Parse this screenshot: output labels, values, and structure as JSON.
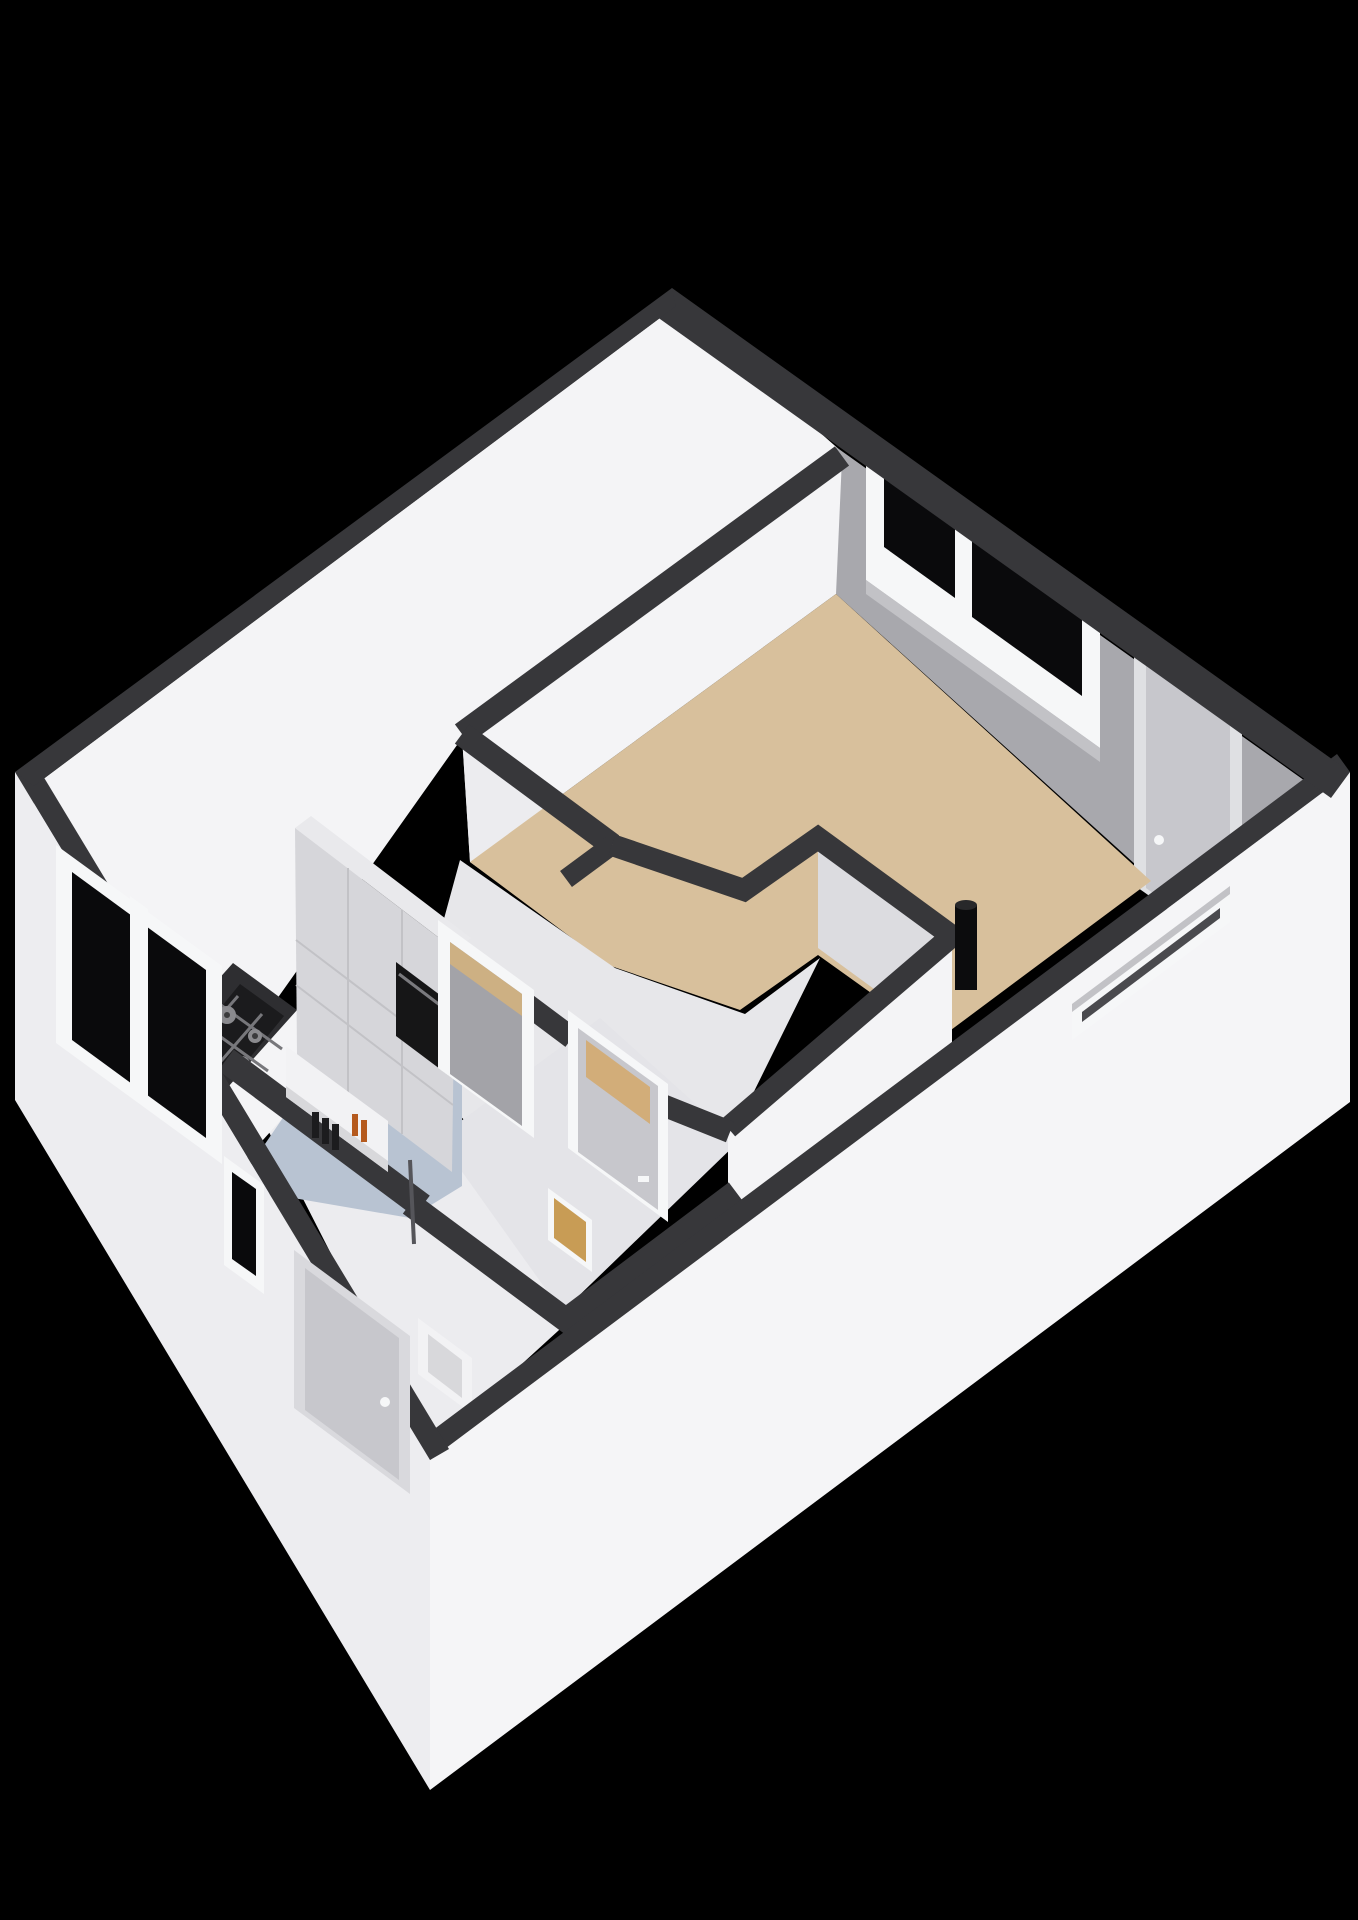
{
  "page": {
    "background": "#000000",
    "kind": "3d-isometric-floorplan-render"
  },
  "colors": {
    "bg": "#000000",
    "wall_top": "#37373a",
    "face_bright": "#f4f4f6",
    "face_white": "#ececef",
    "face_shade": "#dcdce0",
    "face_gray": "#a8a8ad",
    "ext_sw": "#ededf0",
    "ext_se": "#f5f5f7",
    "floor_living": "#d8c09c",
    "floor_kitchen": "#b8c3d2",
    "floor_hall": "#e7e7ea",
    "floor_toilet": "#e4e4e8",
    "glass_dark": "#0a0a0c",
    "frame_white": "#f6f7f8",
    "frame_light": "#dfe0e3",
    "door_gray": "#c7c7cc",
    "door_glass_beige": "#d2ad79",
    "toilet_glass": "#c89c55",
    "transom_beige": "#cdb083",
    "counter_top": "#2e2e31",
    "hob_black": "#1b1b1d",
    "burner_gray": "#8a8a8e",
    "burner_cap": "#3a3a3c",
    "grate": "#77777b",
    "oven_black": "#161617",
    "oven_handle": "#7a7a7e",
    "cabinet_face": "#d6d6da",
    "cabinet_top": "#e9e9ec",
    "cabinet_seam": "#c2c2c6",
    "recess_gray": "#a3a3a8",
    "door_recess": "#d9d9dd",
    "pipe_black": "#0c0c0d",
    "pipe_top": "#28282a",
    "bottle_dark": "#1c1c1e",
    "bottle_orange": "#b55a1e",
    "box_white": "#f2f2f4",
    "box_recess": "#d8d8db",
    "sill_shade": "#c2c2c6",
    "slot_inner": "#4a4a4e",
    "leaf_edge": "#55555a",
    "niche_shade": "#d8d8db"
  },
  "rooms": [
    {
      "id": "living-room",
      "floor_color": "#d8c09c"
    },
    {
      "id": "kitchen",
      "floor_color": "#b8c3d2"
    },
    {
      "id": "hall",
      "floor_color": "#e7e7ea"
    },
    {
      "id": "toilet",
      "floor_color": "#e4e4e8"
    }
  ],
  "fixtures": [
    {
      "id": "kitchen-counter",
      "top_color": "#2e2e31"
    },
    {
      "id": "gas-hob",
      "burners": 4
    },
    {
      "id": "tall-cabinet-wall",
      "panels": true
    },
    {
      "id": "built-in-oven",
      "color": "#161617"
    },
    {
      "id": "wall-niche-shelf",
      "bottles_dark": 3,
      "bottles_orange": 2
    },
    {
      "id": "flue-pipe",
      "color": "#0c0c0d"
    },
    {
      "id": "meter-box",
      "color": "#f2f2f4"
    }
  ],
  "openings": [
    {
      "id": "living-window-ne",
      "panes": 2,
      "glass": "#0a0a0c"
    },
    {
      "id": "living-door-ne",
      "leaf": "#c7c7cc"
    },
    {
      "id": "slot-window-se",
      "inner": "#4a4a4e"
    },
    {
      "id": "kitchen-window-sw",
      "panes": 2,
      "glass": "#0a0a0c"
    },
    {
      "id": "small-window-sw",
      "glass": "#0a0a0c"
    },
    {
      "id": "front-door-sw",
      "leaf": "#c7c7cc"
    },
    {
      "id": "hall-living-door",
      "glass": "#d2ad79"
    },
    {
      "id": "toilet-door",
      "glass": "#c89c55"
    },
    {
      "id": "kitchen-door",
      "transom": "#cdb083"
    }
  ]
}
